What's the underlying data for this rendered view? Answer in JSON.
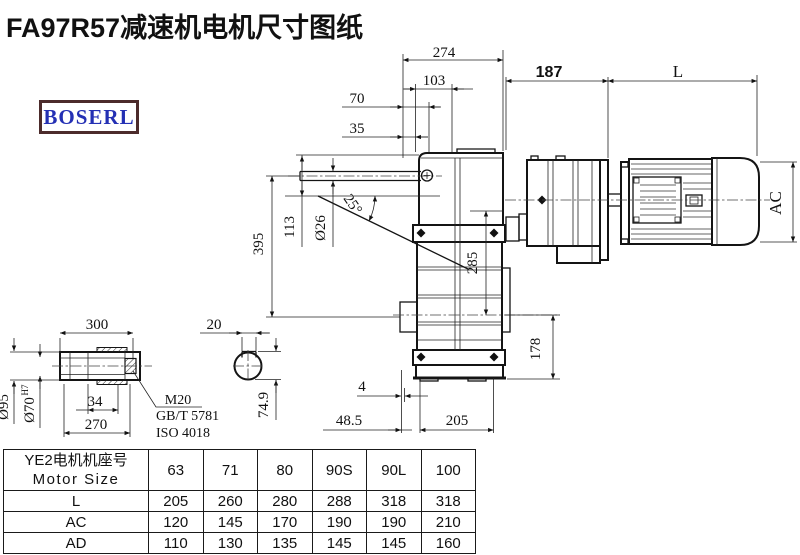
{
  "title": "FA97R57减速机电机尺寸图纸",
  "logo": "BOSERL",
  "drawing": {
    "dims": {
      "w274": "274",
      "w103": "103",
      "w70": "70",
      "w35": "35",
      "w187": "187",
      "wL": "L",
      "ac": "AC",
      "h395": "395",
      "h113": "113",
      "dia26": "Ø26",
      "ang25": "25°",
      "h285": "285",
      "h178": "178",
      "b4": "4",
      "b485": "48.5",
      "b205": "205"
    },
    "detail": {
      "len300": "300",
      "key20": "20",
      "dia95": "Ø95",
      "dia70": "Ø70",
      "sup": "H7",
      "len34": "34",
      "len270": "270",
      "m20": "M20",
      "gbt": "GB/T 5781",
      "iso": "ISO 4018",
      "h749": "74.9"
    }
  },
  "table": {
    "header_cn": "YE2电机机座号",
    "header_en": "Motor Size",
    "sizes": [
      "63",
      "71",
      "80",
      "90S",
      "90L",
      "100"
    ],
    "rows": [
      {
        "label": "L",
        "values": [
          "205",
          "260",
          "280",
          "288",
          "318",
          "318"
        ]
      },
      {
        "label": "AC",
        "values": [
          "120",
          "145",
          "170",
          "190",
          "190",
          "210"
        ]
      },
      {
        "label": "AD",
        "values": [
          "110",
          "130",
          "135",
          "145",
          "145",
          "160"
        ]
      }
    ]
  },
  "colors": {
    "line": "#141414",
    "logo_text": "#2430b4",
    "logo_border": "#4c2b2b"
  }
}
